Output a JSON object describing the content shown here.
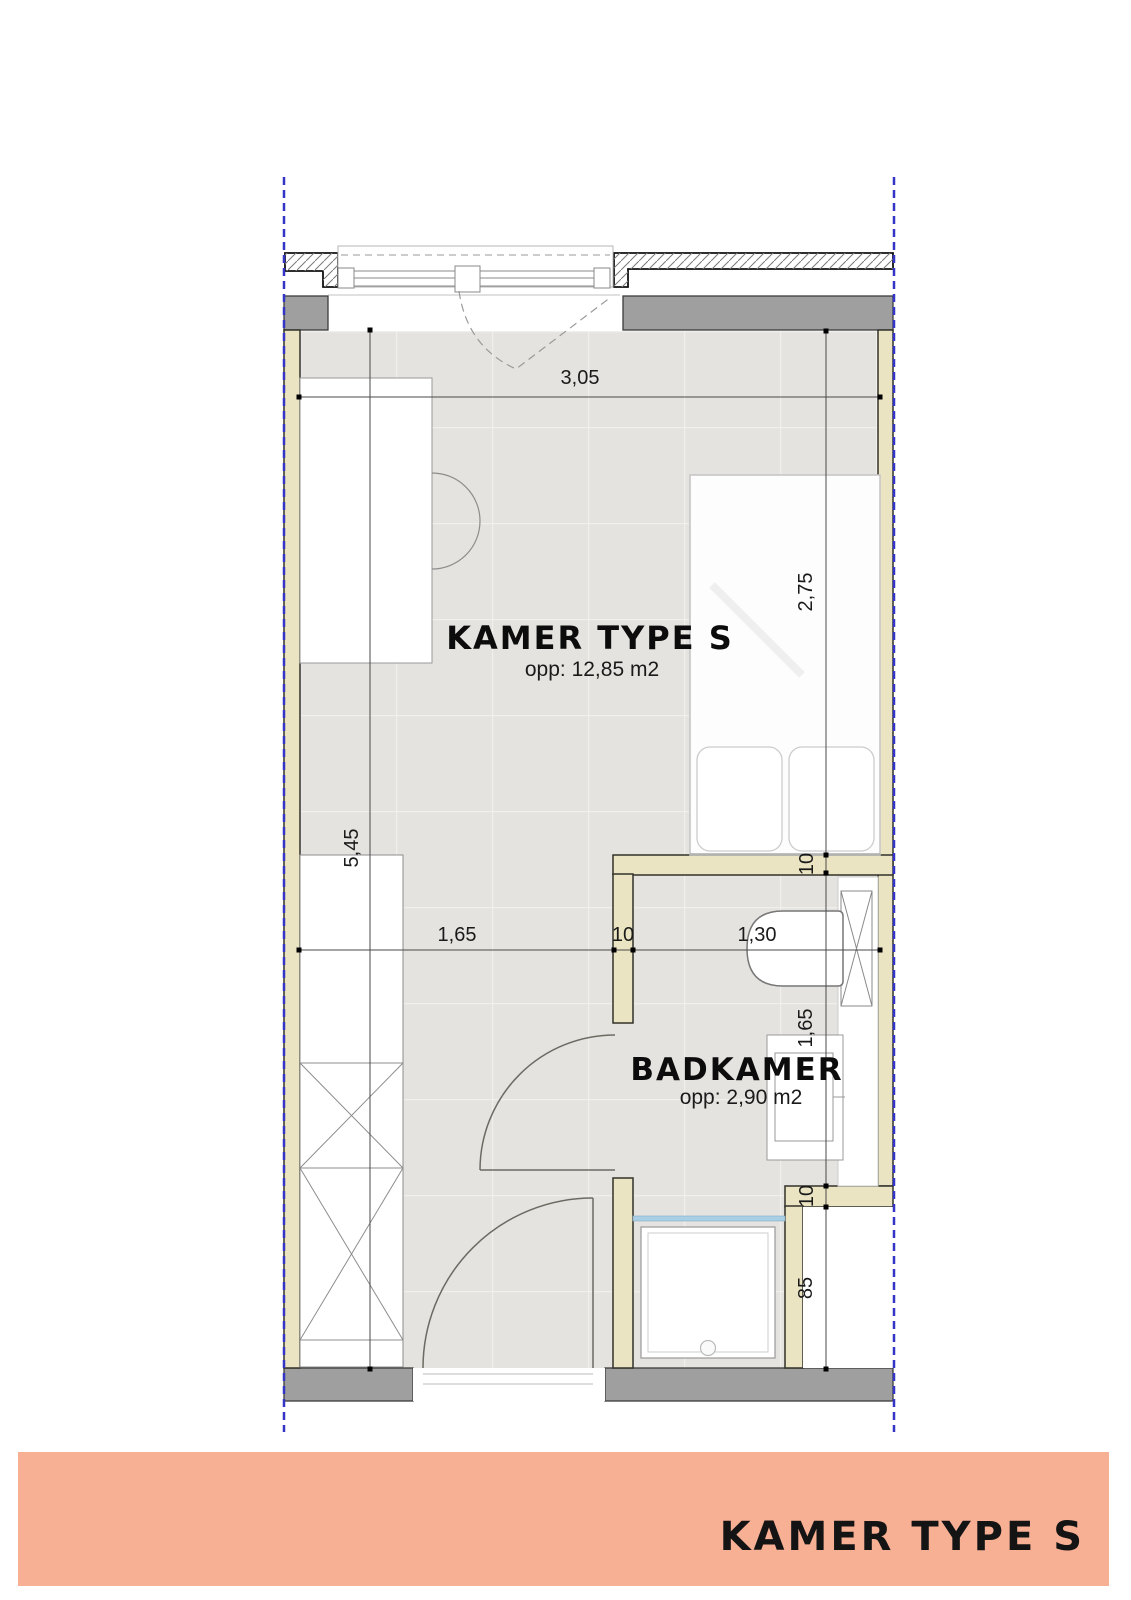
{
  "room": {
    "title": "KAMER TYPE S",
    "area": "opp: 12,85 m2"
  },
  "bathroom": {
    "title": "BADKAMER",
    "area": "opp: 2,90 m2"
  },
  "dimensions": {
    "room_width": "3,05",
    "bed_wall_length": "2,75",
    "room_length": "5,45",
    "closet_to_bathroom": "1,65",
    "bathroom_wall_mid": "10",
    "bathroom_width": "1,30",
    "bathroom_top_wall": "10",
    "bathroom_depth": "1,65",
    "niche_wall": "10",
    "niche_width": "85"
  },
  "banner": {
    "title": "KAMER TYPE S"
  },
  "colors": {
    "banner_background": "#f8b094",
    "wall_beige": "#ebe4c2",
    "wall_gray": "#9f9f9f",
    "floor_tile": "#e5e3df",
    "shower_glass": "#a8cfe6",
    "construction_line_blue": "#3434c6"
  }
}
